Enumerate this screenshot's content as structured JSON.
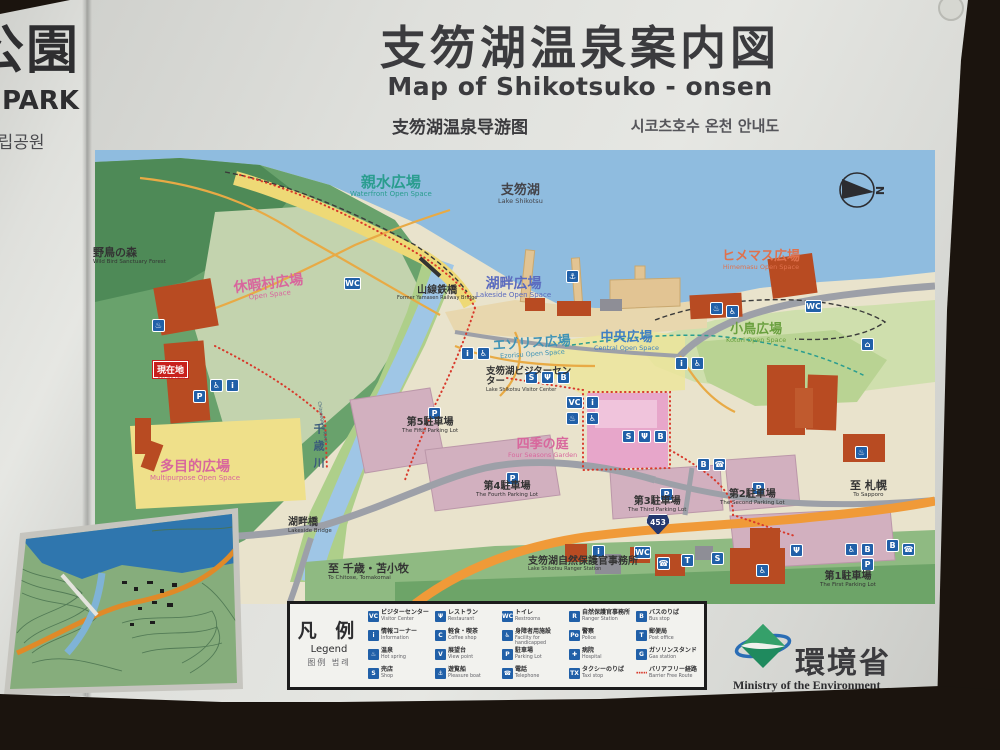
{
  "adjacent_sign": {
    "title_ja": "公園",
    "title_en": "PARK",
    "title_ko": "국립공원"
  },
  "header": {
    "title_ja": "支笏湖温泉案内図",
    "title_en": "Map of Shikotsuko - onsen",
    "title_zh": "支笏湖温泉导游图",
    "title_ko": "시코츠호수 온천 안내도"
  },
  "compass_n": "N",
  "colors": {
    "lake": "#8fbcdf",
    "forest": "#4e8a57",
    "openspace_yellow": "#efe08a",
    "plaza_pink": "#e7a6ca",
    "parking_mauve": "#d2b0bf",
    "highway_orange": "#f09a38",
    "building_red": "#b84b22",
    "icon_blue": "#2160a8",
    "barrier_free_red": "#d8392b"
  },
  "icons": {
    "parking": "P",
    "onsen": "♨",
    "wheelchair": "♿",
    "information": "i",
    "visitor_center": "VC",
    "boat": "⚓",
    "restaurant": "Ψ",
    "toilet": "WC",
    "telephone": "☎",
    "bus": "B",
    "shop": "S",
    "house": "⌂",
    "post": "T",
    "hospital": "✚",
    "police": "Po",
    "taxi": "TX",
    "gas": "G",
    "viewpoint": "V",
    "coffee": "C"
  },
  "map": {
    "you_are_here": {
      "ja": "現在地",
      "en": "You are here"
    },
    "route_shield": "453",
    "labels": [
      {
        "ja": "親水広場",
        "en": "Waterfront Open Space"
      },
      {
        "ja": "支笏湖",
        "en": "Lake Shikotsu"
      },
      {
        "ja": "野鳥の森",
        "en": "Wild Bird Sanctuary Forest"
      },
      {
        "ja": "休暇村広場",
        "en": "Open Space"
      },
      {
        "ja": "山線鉄橋",
        "en": "Former Yamasen Railway Bridge"
      },
      {
        "ja": "湖畔広場",
        "en": "Lakeside Open Space"
      },
      {
        "ja": "ヒメマス広場",
        "en": "Himemasu Open Space"
      },
      {
        "ja": "小鳥広場",
        "en": "Kotori Open Space"
      },
      {
        "ja": "中央広場",
        "en": "Central Open Space"
      },
      {
        "ja": "エゾリス広場",
        "en": "Ezorisu Open Space"
      },
      {
        "ja": "支笏湖ビジターセンター",
        "en": "Lake Shikotsu Visitor Center"
      },
      {
        "ja": "多目的広場",
        "en": "Multipurpose Open Space"
      },
      {
        "ja": "第5駐車場",
        "en": "The Fifth Parking Lot"
      },
      {
        "ja": "四季の庭",
        "en": "Four Seasons Garden"
      },
      {
        "ja": "第4駐車場",
        "en": "The Fourth Parking Lot"
      },
      {
        "ja": "第3駐車場",
        "en": "The Third Parking Lot"
      },
      {
        "ja": "第2駐車場",
        "en": "The Second Parking Lot"
      },
      {
        "ja": "至 札幌",
        "en": "To Sapporo"
      },
      {
        "ja": "湖畔橋",
        "en": "Lakeside Bridge"
      },
      {
        "ja": "至 千歳・苫小牧",
        "en": "To Chitose, Tomakomai"
      },
      {
        "ja": "支笏湖自然保護官事務所",
        "en": "Lake Shikotsu Ranger Station"
      },
      {
        "ja": "第1駐車場",
        "en": "The First Parking Lot"
      },
      {
        "ja": "千歳川",
        "en": "Chitosegawa River"
      }
    ]
  },
  "legend": {
    "title_ja": "凡 例",
    "title_en": "Legend",
    "title_sub": "图例  범례",
    "items": [
      {
        "ja": "ビジターセンター",
        "en": "Visitor Center",
        "glyph": "VC"
      },
      {
        "ja": "情報コーナー",
        "en": "Information",
        "glyph": "i"
      },
      {
        "ja": "温泉",
        "en": "Hot spring",
        "glyph": "♨"
      },
      {
        "ja": "売店",
        "en": "Shop",
        "glyph": "S"
      },
      {
        "ja": "レストラン",
        "en": "Restaurant",
        "glyph": "Ψ"
      },
      {
        "ja": "軽食・喫茶",
        "en": "Coffee shop",
        "glyph": "C"
      },
      {
        "ja": "展望台",
        "en": "View point",
        "glyph": "V"
      },
      {
        "ja": "遊覧船",
        "en": "Pleasure boat",
        "glyph": "⚓"
      },
      {
        "ja": "トイレ",
        "en": "Restrooms",
        "glyph": "WC"
      },
      {
        "ja": "身障者用施設",
        "en": "Facility for handicapped",
        "glyph": "♿"
      },
      {
        "ja": "駐車場",
        "en": "Parking Lot",
        "glyph": "P"
      },
      {
        "ja": "電話",
        "en": "Telephone",
        "glyph": "☎"
      },
      {
        "ja": "自然保護官事務所",
        "en": "Ranger Station",
        "glyph": "R"
      },
      {
        "ja": "警察",
        "en": "Police",
        "glyph": "Po"
      },
      {
        "ja": "病院",
        "en": "Hospital",
        "glyph": "✚"
      },
      {
        "ja": "タクシーのりば",
        "en": "Taxi stop",
        "glyph": "TX"
      },
      {
        "ja": "バスのりば",
        "en": "Bus stop",
        "glyph": "B"
      },
      {
        "ja": "郵便局",
        "en": "Post office",
        "glyph": "T"
      },
      {
        "ja": "ガソリンスタンド",
        "en": "Gas station",
        "glyph": "G"
      },
      {
        "ja": "バリアフリー経路",
        "en": "Barrier Free Route",
        "glyph": "·····"
      }
    ]
  },
  "footer": {
    "ministry_ja": "環境省",
    "ministry_en": "Ministry of the Environment"
  }
}
